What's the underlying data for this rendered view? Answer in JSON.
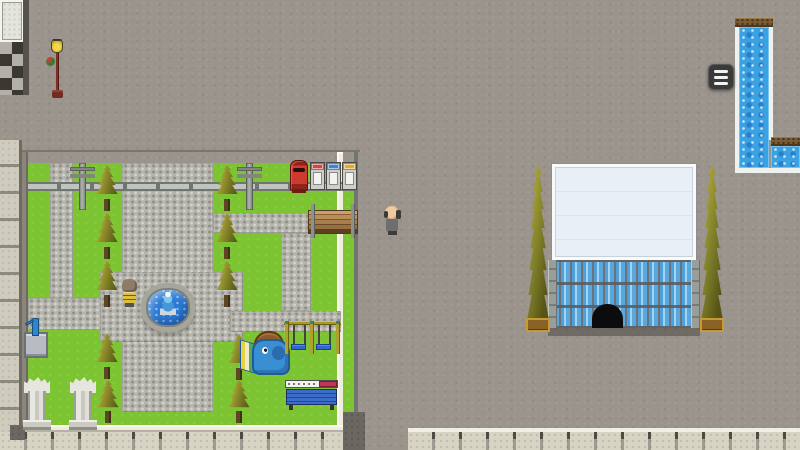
{
  "app": {
    "name": "rpg-town-map-screenshot",
    "view": "overworld-town"
  },
  "palette": {
    "asphalt": "#9b948d",
    "grass": "#7cc431",
    "gravel": "#b5b5ad",
    "cobble": "#cfcbbd",
    "bigtile": "#d8d4c4",
    "water": "#3aa2e2",
    "glass": "#58a8e0",
    "roof": "#e9eff6",
    "fence": "#c0c4be",
    "wood": "#7b5b35",
    "postbox_red": "#cf3a30",
    "menu": "#3a3a3a"
  },
  "hud": {
    "menu_button": {
      "icon": "hamburger-menu-icon",
      "bars": 3
    }
  },
  "scene": {
    "elements": [
      {
        "name": "street-asphalt",
        "type": "asphalt",
        "x": 0,
        "y": 0,
        "w": 800,
        "h": 450,
        "interactable": false
      },
      {
        "name": "street-edge-line",
        "type": "darkline",
        "x": 0,
        "y": 150,
        "w": 360,
        "h": 2,
        "interactable": false
      },
      {
        "name": "shop-floor-tiles",
        "type": "tilepanel",
        "x": 0,
        "y": 0,
        "w": 24,
        "h": 42,
        "interactable": false
      },
      {
        "name": "shop-floor-checker",
        "type": "checker",
        "x": 0,
        "y": 42,
        "w": 24,
        "h": 53,
        "interactable": false
      },
      {
        "name": "shop-wall-edge",
        "type": "edgedark",
        "x": 23,
        "y": 0,
        "w": 6,
        "h": 95,
        "interactable": false
      },
      {
        "name": "park-sidewalk-west",
        "type": "cobble",
        "x": 0,
        "y": 140,
        "w": 22,
        "h": 310,
        "interactable": false
      },
      {
        "name": "park-wall-west",
        "type": "walldark",
        "x": 22,
        "y": 152,
        "w": 6,
        "h": 280,
        "interactable": false
      },
      {
        "name": "park-grass",
        "type": "grass",
        "x": 28,
        "y": 163,
        "w": 309,
        "h": 262,
        "interactable": false
      },
      {
        "name": "park-wall-east",
        "type": "wallwhite",
        "x": 337,
        "y": 152,
        "w": 6,
        "h": 280,
        "interactable": false
      },
      {
        "name": "park-grass-corridor",
        "type": "grass",
        "x": 343,
        "y": 163,
        "w": 11,
        "h": 249,
        "interactable": false
      },
      {
        "name": "corridor-fence-east",
        "type": "fencev",
        "x": 354,
        "y": 152,
        "w": 4,
        "h": 260,
        "interactable": false
      },
      {
        "name": "south-road",
        "type": "road",
        "x": 343,
        "y": 412,
        "w": 22,
        "h": 38,
        "interactable": false
      },
      {
        "name": "park-path-west",
        "type": "gravel",
        "x": 50,
        "y": 163,
        "w": 23,
        "h": 157,
        "interactable": false
      },
      {
        "name": "park-path-west-horizontal",
        "type": "gravel",
        "x": 28,
        "y": 298,
        "w": 97,
        "h": 32,
        "interactable": false
      },
      {
        "name": "park-path-central",
        "type": "gravel",
        "x": 122,
        "y": 163,
        "w": 91,
        "h": 249,
        "interactable": false
      },
      {
        "name": "fountain-plaza",
        "type": "gravel",
        "x": 100,
        "y": 272,
        "w": 143,
        "h": 70,
        "interactable": false
      },
      {
        "name": "park-path-east-horizontal",
        "type": "gravel",
        "x": 213,
        "y": 213,
        "w": 98,
        "h": 20,
        "interactable": false
      },
      {
        "name": "park-path-east-vertical",
        "type": "gravel",
        "x": 281,
        "y": 233,
        "w": 30,
        "h": 78,
        "interactable": false
      },
      {
        "name": "playground-path",
        "type": "gravel",
        "x": 230,
        "y": 311,
        "w": 111,
        "h": 21,
        "interactable": false
      },
      {
        "name": "park-fence-north",
        "type": "fenceh",
        "x": 28,
        "y": 182,
        "w": 326,
        "h": 9,
        "interactable": false
      },
      {
        "name": "park-wall-south",
        "type": "wallwhite",
        "x": 22,
        "y": 425,
        "w": 321,
        "h": 7,
        "interactable": false
      },
      {
        "name": "sidewalk-south-west",
        "type": "bigtile",
        "x": 0,
        "y": 432,
        "w": 343,
        "h": 18,
        "interactable": false
      },
      {
        "name": "sidewalk-corner-dark-tile",
        "type": "road",
        "x": 10,
        "y": 425,
        "w": 15,
        "h": 15,
        "interactable": false
      },
      {
        "name": "sidewalk-south-east",
        "type": "bigtile",
        "cls": "edged",
        "x": 408,
        "y": 428,
        "w": 392,
        "h": 22,
        "interactable": false
      },
      {
        "name": "canal-border-west",
        "type": "wborder",
        "x": 735,
        "y": 24,
        "w": 4,
        "h": 149,
        "interactable": false
      },
      {
        "name": "canal-border-east-upper",
        "type": "wborder",
        "x": 769,
        "y": 24,
        "w": 4,
        "h": 116,
        "interactable": false
      },
      {
        "name": "canal-dock-north",
        "type": "dock",
        "x": 735,
        "y": 18,
        "w": 38,
        "h": 9,
        "interactable": false
      },
      {
        "name": "canal-water-vertical",
        "type": "water",
        "x": 739,
        "y": 27,
        "w": 30,
        "h": 141,
        "interactable": false
      },
      {
        "name": "canal-dock-east",
        "type": "dock",
        "x": 771,
        "y": 137,
        "w": 29,
        "h": 9,
        "interactable": false
      },
      {
        "name": "canal-water-east",
        "type": "water",
        "x": 771,
        "y": 146,
        "w": 29,
        "h": 22,
        "interactable": false
      },
      {
        "name": "canal-border-south",
        "type": "wborder",
        "x": 735,
        "y": 168,
        "w": 38,
        "h": 5,
        "interactable": false
      },
      {
        "name": "canal-border-south-east",
        "type": "wborder",
        "x": 771,
        "y": 168,
        "w": 29,
        "h": 5,
        "interactable": false
      },
      {
        "name": "utility-pole-west",
        "type": "pole",
        "x": 79,
        "y": 163,
        "w": 7,
        "h": 47,
        "interactable": false
      },
      {
        "name": "utility-pole-east",
        "type": "pole",
        "x": 246,
        "y": 163,
        "w": 7,
        "h": 47,
        "interactable": false
      },
      {
        "name": "postbox",
        "type": "postbox",
        "x": 290,
        "y": 160,
        "w": 18,
        "h": 31,
        "interactable": false
      },
      {
        "name": "vending-machine-red",
        "type": "vending",
        "x": 310,
        "y": 162,
        "w": 15,
        "h": 28,
        "color": "#cf4840",
        "interactable": false
      },
      {
        "name": "vending-machine-blue",
        "type": "vending",
        "x": 326,
        "y": 162,
        "w": 15,
        "h": 28,
        "color": "#4284cc",
        "interactable": false
      },
      {
        "name": "vending-machine-yellow",
        "type": "vending",
        "x": 342,
        "y": 162,
        "w": 15,
        "h": 28,
        "color": "#e2ac30",
        "interactable": false
      },
      {
        "name": "park-tree",
        "type": "conifer",
        "x": 95,
        "y": 165,
        "w": 24,
        "h": 48,
        "interactable": false
      },
      {
        "name": "park-tree",
        "type": "conifer",
        "x": 95,
        "y": 213,
        "w": 24,
        "h": 48,
        "interactable": false
      },
      {
        "name": "park-tree",
        "type": "conifer",
        "x": 95,
        "y": 261,
        "w": 24,
        "h": 48,
        "interactable": false
      },
      {
        "name": "park-tree",
        "type": "conifer",
        "x": 95,
        "y": 333,
        "w": 24,
        "h": 48,
        "interactable": false
      },
      {
        "name": "park-tree",
        "type": "conifer",
        "x": 96,
        "y": 380,
        "w": 24,
        "h": 45,
        "interactable": false
      },
      {
        "name": "park-tree",
        "type": "conifer",
        "x": 215,
        "y": 165,
        "w": 24,
        "h": 48,
        "interactable": false
      },
      {
        "name": "park-tree",
        "type": "conifer",
        "x": 215,
        "y": 213,
        "w": 24,
        "h": 48,
        "interactable": false
      },
      {
        "name": "park-tree",
        "type": "conifer",
        "x": 215,
        "y": 261,
        "w": 24,
        "h": 48,
        "interactable": false
      },
      {
        "name": "park-tree",
        "type": "conifer",
        "x": 227,
        "y": 334,
        "w": 24,
        "h": 48,
        "interactable": false
      },
      {
        "name": "park-tree",
        "type": "conifer",
        "x": 227,
        "y": 380,
        "w": 24,
        "h": 45,
        "interactable": false
      },
      {
        "name": "wooden-bench",
        "type": "benchwood",
        "x": 308,
        "y": 210,
        "w": 50,
        "h": 24,
        "interactable": false
      },
      {
        "name": "fountain",
        "type": "fountain",
        "x": 141,
        "y": 283,
        "w": 54,
        "h": 49,
        "interactable": false
      },
      {
        "name": "npc-child",
        "type": "npcchild",
        "x": 120,
        "y": 279,
        "w": 19,
        "h": 29,
        "interactable": false
      },
      {
        "name": "water-pump",
        "type": "pump",
        "x": 24,
        "y": 318,
        "w": 24,
        "h": 40,
        "interactable": false
      },
      {
        "name": "marble-column",
        "type": "column",
        "x": 24,
        "y": 377,
        "w": 26,
        "h": 53,
        "interactable": false
      },
      {
        "name": "marble-column",
        "type": "column",
        "x": 70,
        "y": 377,
        "w": 26,
        "h": 53,
        "interactable": false
      },
      {
        "name": "elephant-slide",
        "type": "elephant",
        "x": 240,
        "y": 331,
        "w": 52,
        "h": 48,
        "interactable": false
      },
      {
        "name": "swing-set",
        "type": "swing",
        "x": 284,
        "y": 319,
        "w": 57,
        "h": 37,
        "interactable": false
      },
      {
        "name": "park-sign-bench",
        "type": "signtable",
        "x": 285,
        "y": 380,
        "w": 53,
        "h": 30,
        "interactable": false
      },
      {
        "name": "street-lamp",
        "type": "lamp",
        "x": 46,
        "y": 40,
        "w": 22,
        "h": 58,
        "interactable": false
      },
      {
        "name": "department-store",
        "type": "building",
        "x": 548,
        "y": 164,
        "w": 152,
        "h": 172,
        "interactable": false
      },
      {
        "name": "store-tree-west",
        "type": "bigtree",
        "x": 526,
        "y": 164,
        "w": 24,
        "h": 156,
        "interactable": false
      },
      {
        "name": "store-planter-west",
        "type": "planter",
        "x": 526,
        "y": 318,
        "w": 24,
        "h": 14,
        "interactable": false
      },
      {
        "name": "store-tree-east",
        "type": "bigtree",
        "x": 700,
        "y": 164,
        "w": 24,
        "h": 156,
        "interactable": false
      },
      {
        "name": "store-planter-east",
        "type": "planter",
        "x": 700,
        "y": 318,
        "w": 24,
        "h": 14,
        "interactable": false
      },
      {
        "name": "npc-player",
        "type": "npcplayer",
        "x": 382,
        "y": 204,
        "w": 21,
        "h": 33,
        "interactable": false
      },
      {
        "name": "menu-button",
        "type": "menubtn",
        "x": 708,
        "y": 64,
        "w": 26,
        "h": 26,
        "interactable": true
      }
    ]
  }
}
